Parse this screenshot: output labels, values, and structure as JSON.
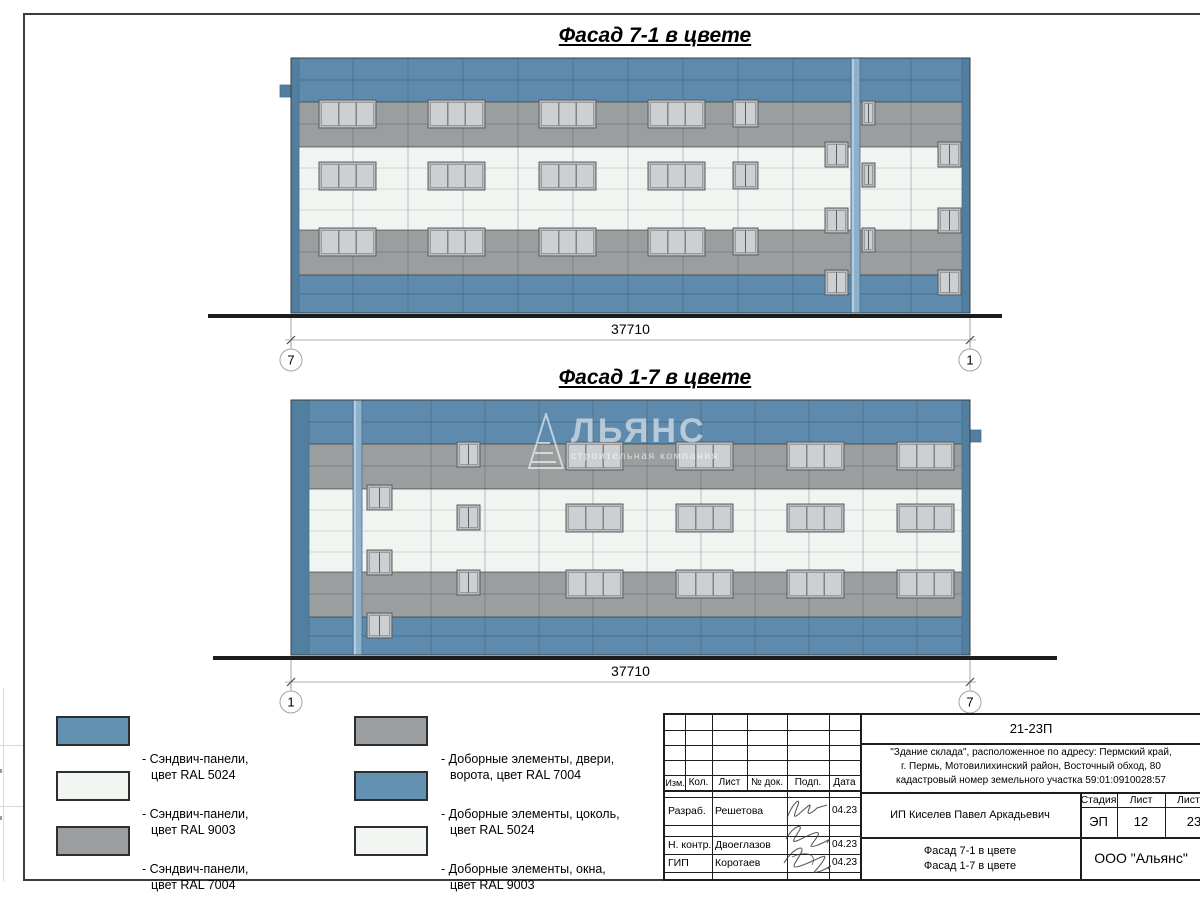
{
  "colors": {
    "blue": "#5e8bad",
    "blueLine": "#43708f",
    "blueEdge": "#527f9f",
    "gray": "#9b9e9f",
    "grayLine": "#7e8183",
    "white": "#f1f5f2",
    "whiteLine": "#d3d7d4",
    "pilaster": "#8db0cb",
    "pilasterDark": "#48708f",
    "pilasterLight": "#cfdfea",
    "boundary": "rgba(20,35,45,0.45)",
    "vjoint": "rgba(50,70,85,0.32)",
    "winFrame": "#b8bbbd",
    "winPane": "#cdd0d2",
    "winStroke": "#5a5d5f",
    "winDivider": "#8f9294",
    "ground": "#1c1c1c",
    "dim": "#909090",
    "bubbleStroke": "#a3a3a3",
    "ral5024": "#6291b2",
    "ral9003": "#f2f6f3",
    "ral7004": "#9b9ea0"
  },
  "facade_drawing": {
    "building": {
      "w": 679,
      "h": 255
    },
    "bands": [
      {
        "y": 0,
        "h": 44,
        "c": "blue"
      },
      {
        "y": 44,
        "h": 45,
        "c": "gray"
      },
      {
        "y": 89,
        "h": 83,
        "c": "white"
      },
      {
        "y": 172,
        "h": 45,
        "c": "gray"
      },
      {
        "y": 217,
        "h": 38,
        "c": "blue"
      }
    ],
    "h_joints": [
      {
        "y": 22,
        "c": "blueLine"
      },
      {
        "y": 66,
        "c": "grayLine"
      },
      {
        "y": 110,
        "c": "whiteLine"
      },
      {
        "y": 131,
        "c": "whiteLine"
      },
      {
        "y": 152,
        "c": "whiteLine"
      },
      {
        "y": 194,
        "c": "grayLine"
      },
      {
        "y": 236,
        "c": "blueLine"
      }
    ],
    "boundaries": [
      44,
      89,
      172,
      217
    ]
  },
  "facades": [
    {
      "title": "Фасад 7-1 в цвете",
      "dim": "37710",
      "axis_left": "7",
      "axis_right": "1",
      "v_joints": [
        62,
        117,
        172,
        227,
        282,
        337,
        392,
        447,
        502,
        620
      ],
      "edge_left_w": 8,
      "edge_right_w": 8,
      "pilaster_x": 560,
      "tab_side": "left",
      "tab_y": 27,
      "ground_x1": -83,
      "ground_x2": 711,
      "windows": [
        {
          "x": 28,
          "y": 42,
          "w": 57,
          "h": 28,
          "p": 3
        },
        {
          "x": 137,
          "y": 42,
          "w": 57,
          "h": 28,
          "p": 3
        },
        {
          "x": 248,
          "y": 42,
          "w": 57,
          "h": 28,
          "p": 3
        },
        {
          "x": 357,
          "y": 42,
          "w": 57,
          "h": 28,
          "p": 3
        },
        {
          "x": 442,
          "y": 42,
          "w": 25,
          "h": 27,
          "p": 2
        },
        {
          "x": 571,
          "y": 43,
          "w": 13,
          "h": 24,
          "p": 2
        },
        {
          "x": 28,
          "y": 104,
          "w": 57,
          "h": 28,
          "p": 3
        },
        {
          "x": 137,
          "y": 104,
          "w": 57,
          "h": 28,
          "p": 3
        },
        {
          "x": 248,
          "y": 104,
          "w": 57,
          "h": 28,
          "p": 3
        },
        {
          "x": 357,
          "y": 104,
          "w": 57,
          "h": 28,
          "p": 3
        },
        {
          "x": 442,
          "y": 104,
          "w": 25,
          "h": 27,
          "p": 2
        },
        {
          "x": 571,
          "y": 105,
          "w": 13,
          "h": 24,
          "p": 2
        },
        {
          "x": 28,
          "y": 170,
          "w": 57,
          "h": 28,
          "p": 3
        },
        {
          "x": 137,
          "y": 170,
          "w": 57,
          "h": 28,
          "p": 3
        },
        {
          "x": 248,
          "y": 170,
          "w": 57,
          "h": 28,
          "p": 3
        },
        {
          "x": 357,
          "y": 170,
          "w": 57,
          "h": 28,
          "p": 3
        },
        {
          "x": 442,
          "y": 170,
          "w": 25,
          "h": 27,
          "p": 2
        },
        {
          "x": 571,
          "y": 170,
          "w": 13,
          "h": 24,
          "p": 2
        },
        {
          "x": 534,
          "y": 84,
          "w": 23,
          "h": 25,
          "p": 2
        },
        {
          "x": 647,
          "y": 84,
          "w": 23,
          "h": 25,
          "p": 2
        },
        {
          "x": 534,
          "y": 150,
          "w": 23,
          "h": 25,
          "p": 2
        },
        {
          "x": 647,
          "y": 150,
          "w": 23,
          "h": 25,
          "p": 2
        },
        {
          "x": 534,
          "y": 212,
          "w": 23,
          "h": 25,
          "p": 2
        },
        {
          "x": 647,
          "y": 212,
          "w": 23,
          "h": 25,
          "p": 2
        }
      ]
    },
    {
      "title": "Фасад 1-7 в цвете",
      "dim": "37710",
      "axis_left": "1",
      "axis_right": "7",
      "v_joints": [
        140,
        194,
        248,
        302,
        356,
        410,
        464,
        518,
        572,
        626
      ],
      "edge_left_w": 18,
      "edge_right_w": 8,
      "pilaster_x": 62,
      "tab_side": "right",
      "tab_y": 30,
      "ground_x1": -78,
      "ground_x2": 766,
      "windows": [
        {
          "x": 76,
          "y": 85,
          "w": 25,
          "h": 25,
          "p": 2
        },
        {
          "x": 76,
          "y": 150,
          "w": 25,
          "h": 25,
          "p": 2
        },
        {
          "x": 76,
          "y": 213,
          "w": 25,
          "h": 25,
          "p": 2
        },
        {
          "x": 166,
          "y": 42,
          "w": 23,
          "h": 25,
          "p": 2
        },
        {
          "x": 166,
          "y": 105,
          "w": 23,
          "h": 25,
          "p": 2
        },
        {
          "x": 166,
          "y": 170,
          "w": 23,
          "h": 25,
          "p": 2
        },
        {
          "x": 275,
          "y": 42,
          "w": 57,
          "h": 28,
          "p": 3
        },
        {
          "x": 385,
          "y": 42,
          "w": 57,
          "h": 28,
          "p": 3
        },
        {
          "x": 496,
          "y": 42,
          "w": 57,
          "h": 28,
          "p": 3
        },
        {
          "x": 606,
          "y": 42,
          "w": 57,
          "h": 28,
          "p": 3
        },
        {
          "x": 275,
          "y": 104,
          "w": 57,
          "h": 28,
          "p": 3
        },
        {
          "x": 385,
          "y": 104,
          "w": 57,
          "h": 28,
          "p": 3
        },
        {
          "x": 496,
          "y": 104,
          "w": 57,
          "h": 28,
          "p": 3
        },
        {
          "x": 606,
          "y": 104,
          "w": 57,
          "h": 28,
          "p": 3
        },
        {
          "x": 275,
          "y": 170,
          "w": 57,
          "h": 28,
          "p": 3
        },
        {
          "x": 385,
          "y": 170,
          "w": 57,
          "h": 28,
          "p": 3
        },
        {
          "x": 496,
          "y": 170,
          "w": 57,
          "h": 28,
          "p": 3
        },
        {
          "x": 606,
          "y": 170,
          "w": 57,
          "h": 28,
          "p": 3
        }
      ]
    }
  ],
  "watermark": {
    "brand": "АЛЬЯНС",
    "wordmark_tail": "ЛЬЯНС",
    "subtitle": "строительная компания"
  },
  "legend": [
    {
      "swatch": "#6291b2",
      "line1": "- Сэндвич-панели,",
      "line2": "цвет RAL 5024"
    },
    {
      "swatch": "#f2f6f3",
      "line1": "- Сэндвич-панели,",
      "line2": "цвет RAL 9003"
    },
    {
      "swatch": "#9b9ea0",
      "line1": "- Сэндвич-панели,",
      "line2": "цвет RAL 7004"
    },
    {
      "swatch": "#9b9ea0",
      "line1": "- Доборные элементы, двери,",
      "line2": "ворота, цвет RAL 7004"
    },
    {
      "swatch": "#6291b2",
      "line1": "- Доборные элементы, цоколь,",
      "line2": "цвет RAL 5024"
    },
    {
      "swatch": "#f2f6f3",
      "line1": "- Доборные элементы, окна,",
      "line2": "цвет RAL 9003"
    }
  ],
  "titleblock": {
    "code": "21-23П",
    "address_line1": "\"Здание склада\", расположенное по адресу: Пермский край,",
    "address_line2": "г. Пермь, Мотовилихинский район, Восточный обход, 80",
    "address_line3": "кадастровый номер земельного участка 59:01:0910028:57",
    "col_izm": "Изм.",
    "col_kol": "Кол.",
    "col_list": "Лист",
    "col_doc": "№ док.",
    "col_podp": "Подп.",
    "col_data": "Дата",
    "row1_role": "Разраб.",
    "row1_name": "Решетова",
    "row1_date": "04.23",
    "row2_role": "Н. контр.",
    "row2_name": "Двоеглазов",
    "row2_date": "04.23",
    "row3_role": "ГИП",
    "row3_name": "Коротаев",
    "row3_date": "04.23",
    "client": "ИП Киселев Павел Аркадьевич",
    "sheet_title_line1": "Фасад 7-1 в цвете",
    "sheet_title_line2": "Фасад 1-7 в цвете",
    "stage_label": "Стадия",
    "sheet_label": "Лист",
    "sheets_label": "Листов",
    "stage": "ЭП",
    "sheet_no": "12",
    "sheets_total": "23",
    "company": "ООО \"Альянс\""
  }
}
